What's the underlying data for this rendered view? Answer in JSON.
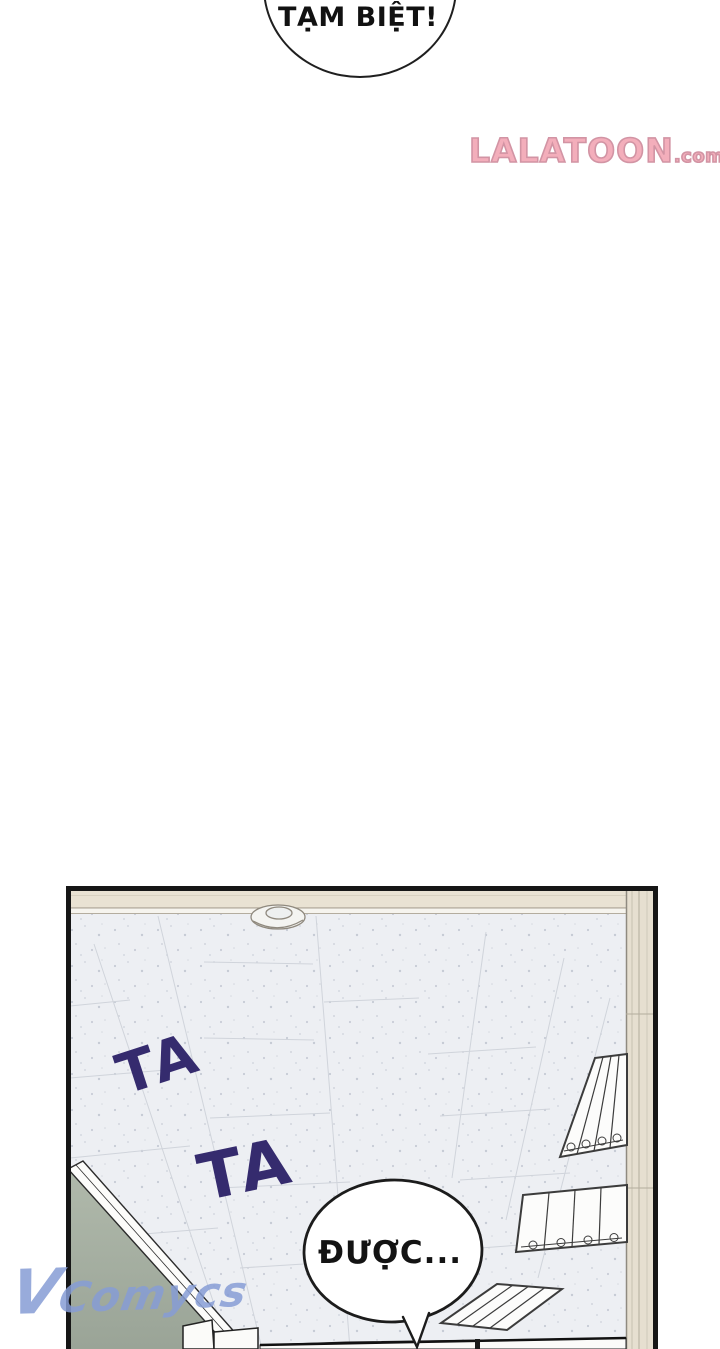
{
  "page": {
    "width": 720,
    "height": 1349,
    "background": "#ffffff"
  },
  "top_bubble": {
    "text": "TẠM BIỆT!"
  },
  "logo": {
    "text": "LALATOON",
    "suffix": ".com",
    "fill": "#f3aebb",
    "outline": "#d294a4"
  },
  "panel": {
    "sfx_1": "TA",
    "sfx_2": "TA",
    "speech_bubble": {
      "text": "ĐƯỢC..."
    },
    "colors": {
      "ceiling": "#edeff3",
      "molding": "#e9e2d3",
      "wall_strip": "#e6dfd0",
      "green_wall": "#a7b1a1",
      "sfx": "#352b6e",
      "line_art": "#3c3c3c",
      "border": "#161616"
    }
  },
  "watermark": {
    "text": "VComycs",
    "color": "#869cd5"
  }
}
